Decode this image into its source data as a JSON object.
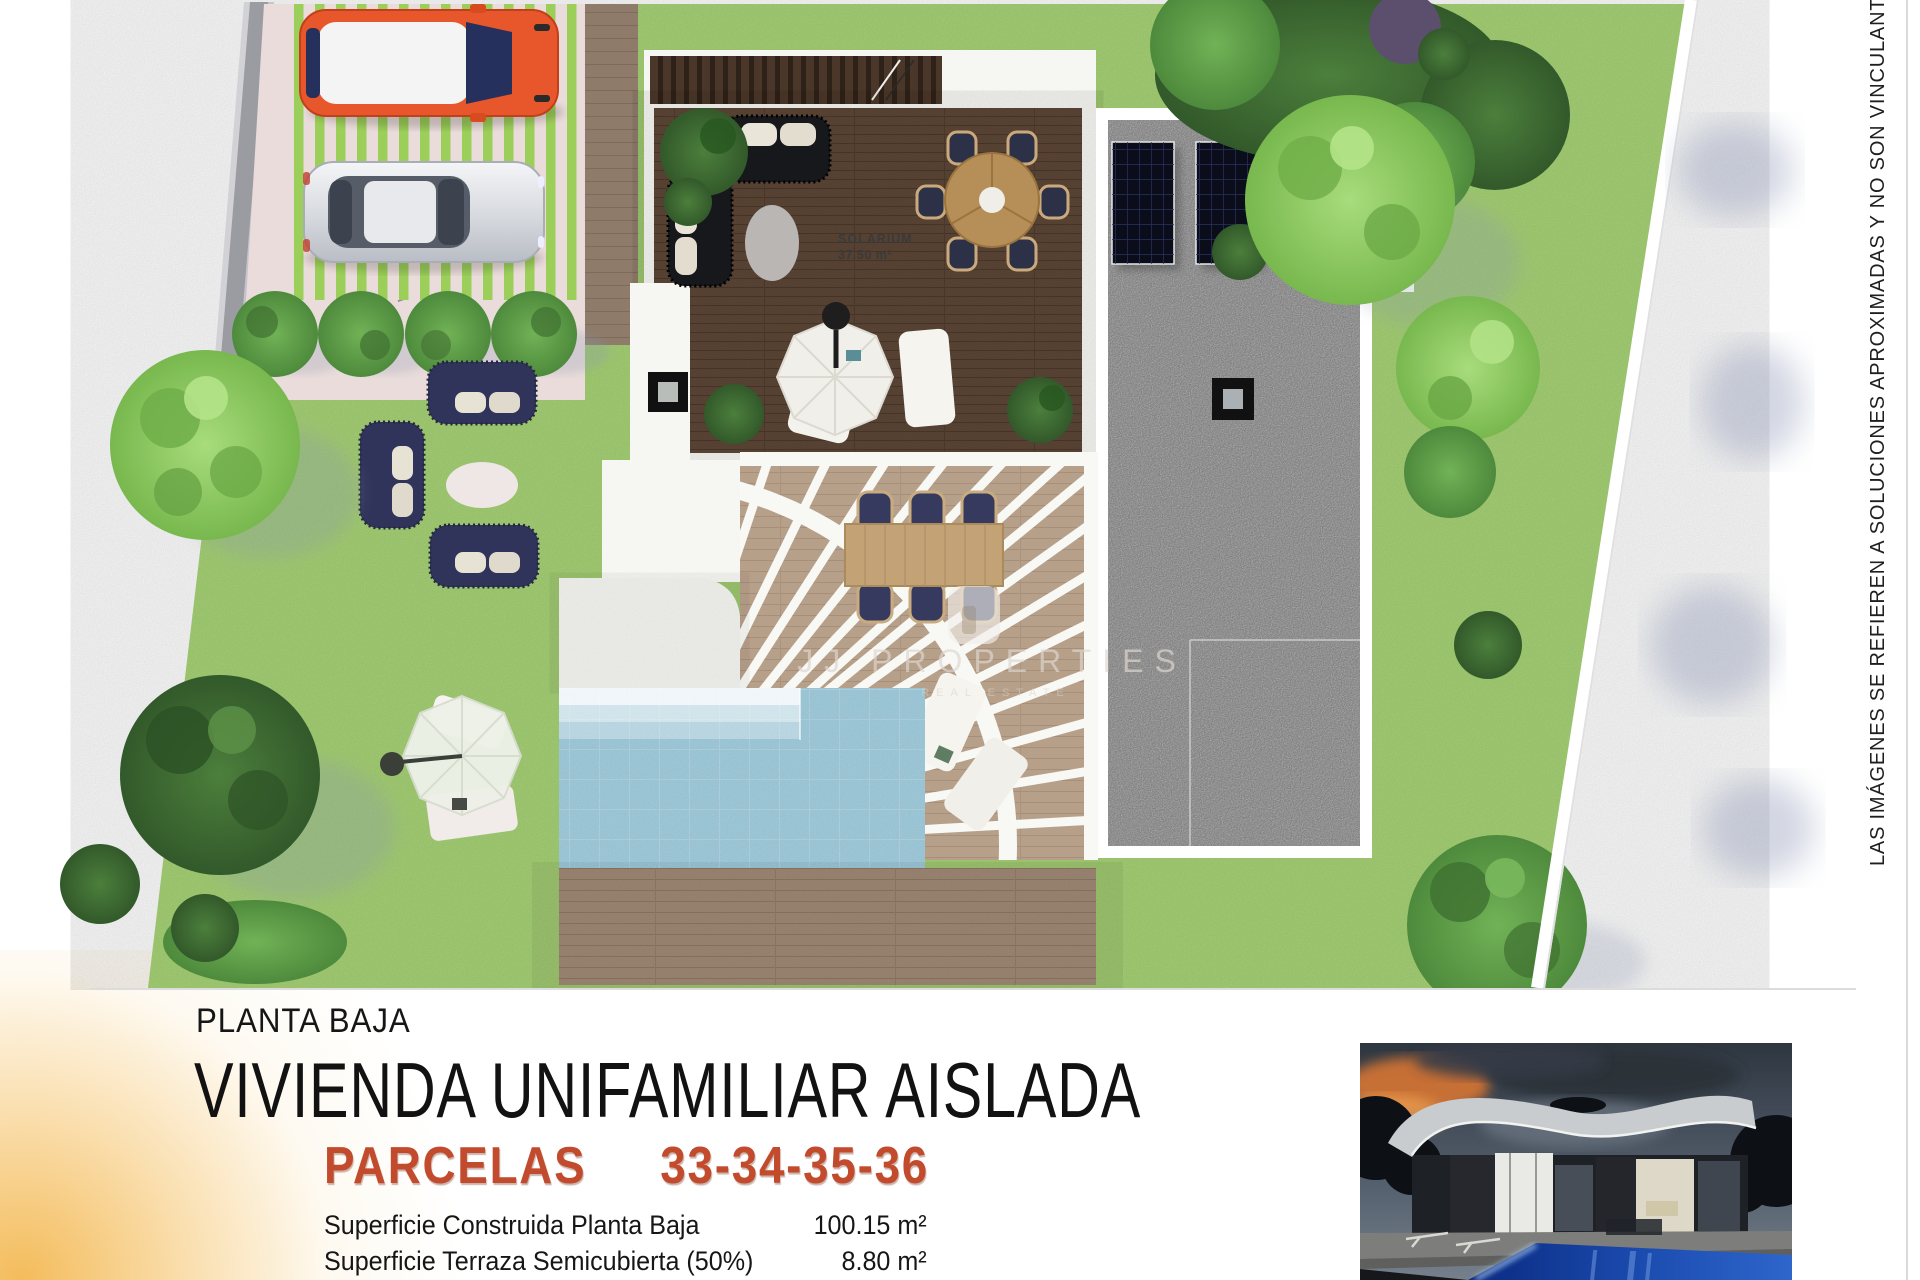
{
  "plan": {
    "solarium_label": "SOLARIUM",
    "solarium_area": "37.50 m²",
    "watermark_title": "JJ PROPERTIES",
    "watermark_subtitle": "REAL ESTATE",
    "disclaimer": "LAS IMÁGENES SE REFIEREN A SOLUCIONES APROXIMADAS Y NO SON VINCULANTES AL PROYECTO"
  },
  "info": {
    "floor_label": "PLANTA BAJA",
    "title": "VIVIENDA UNIFAMILIAR AISLADA",
    "parcels_label": "PARCELAS",
    "parcels_numbers": "33-34-35-36",
    "areas": [
      {
        "label": "Superficie Construida Planta Baja",
        "value": "100.15 m²"
      },
      {
        "label": "Superficie Terraza Semicubierta (50%)",
        "value": "8.80 m²"
      }
    ]
  },
  "colors": {
    "accent": "#c14b2c",
    "lawn": "#a9d578",
    "pool": "#a9d6e8",
    "deck_wood": "#5c4636"
  }
}
